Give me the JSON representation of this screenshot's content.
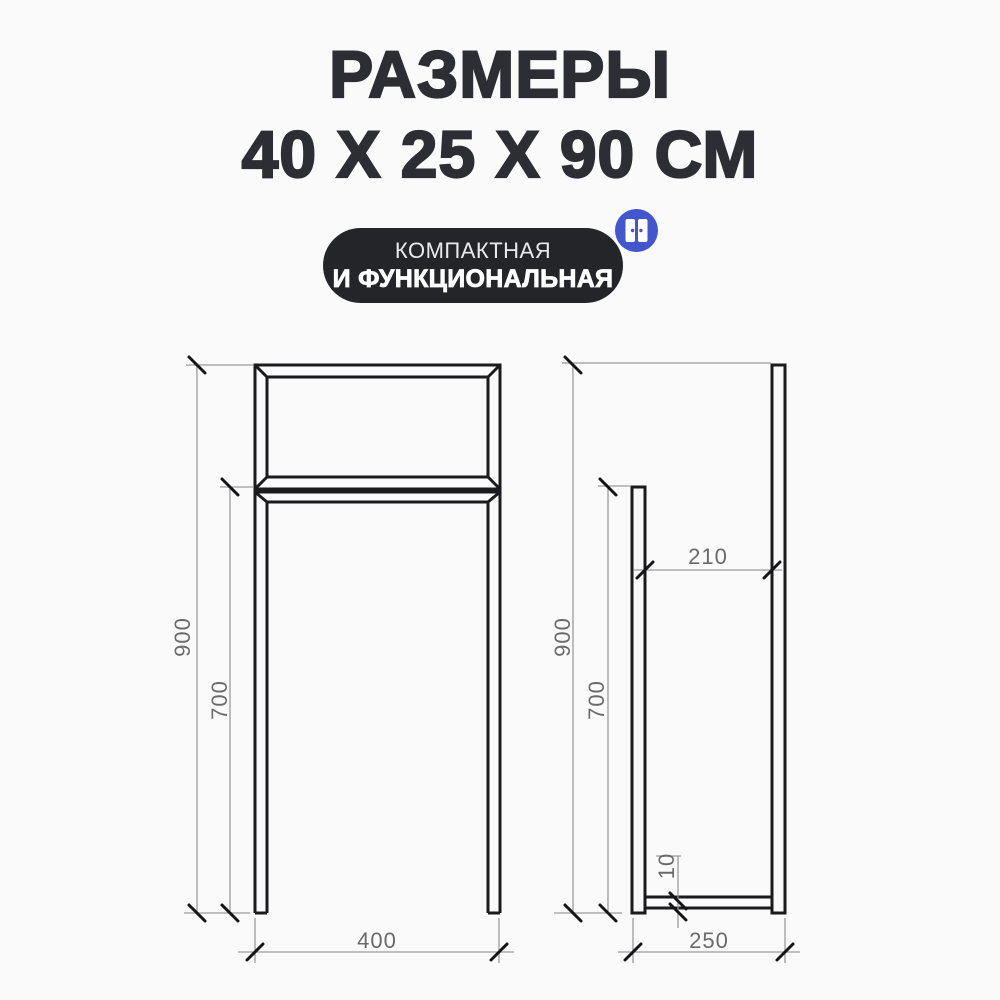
{
  "page": {
    "background": "#fafafb"
  },
  "title": {
    "line1": "РАЗМЕРЫ",
    "line2": "40 Х 25 Х 90 СМ",
    "color": "#2c2e34"
  },
  "badge": {
    "line1": "КОМПАКТНАЯ",
    "line2": "И ФУНКЦИОНАЛЬНАЯ",
    "background": "#232529",
    "icon": {
      "name": "wardrobe-double-doors-icon",
      "circle_color": "#4456cd",
      "door_color": "#ffffff"
    }
  },
  "diagram": {
    "line_color": "#1b1b1d",
    "dim_line_color": "#9c9c9e",
    "dim_text_color": "#6a6a6a",
    "front_view": {
      "name": "front view",
      "dim_height": "900",
      "dim_leg_height": "700",
      "dim_width": "400"
    },
    "side_view": {
      "name": "side view",
      "dim_height": "900",
      "dim_post_height": "700",
      "dim_inner_gap": "210",
      "dim_bar_offset": "10",
      "dim_depth": "250"
    }
  }
}
